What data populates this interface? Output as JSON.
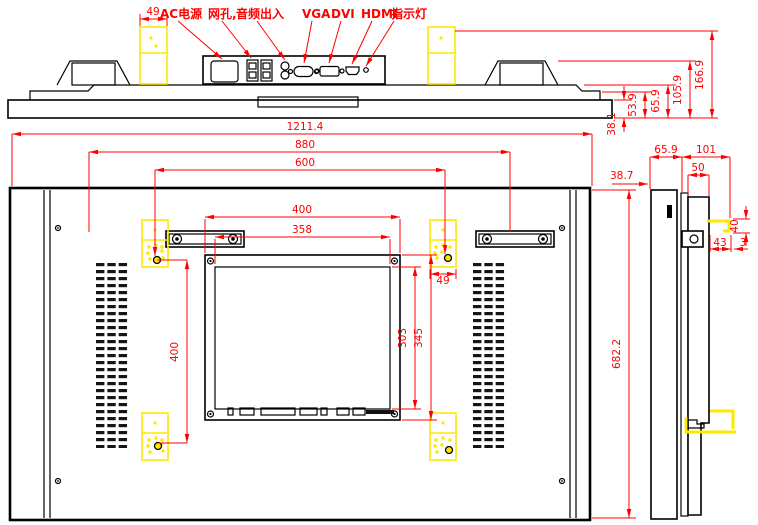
{
  "callouts": {
    "ac_power": "AC电源",
    "lan": "网孔,",
    "audio": "音频出入",
    "vga": "VGA",
    "dvi": "DVI",
    "hdmi": "HDMI",
    "indicator": "指示灯"
  },
  "dims": {
    "top": {
      "bracket_w": "49",
      "step": "53.9",
      "front": "65.9",
      "mid": "105.9",
      "overall": "166.9",
      "body": "38.1"
    },
    "rear": {
      "overall_w": "1211.4",
      "handle_span": "880",
      "mount_span_w": "600",
      "box_w": "400",
      "box_inner_w": "358",
      "block_w": "49",
      "mount_span_h": "400",
      "box_inner_h": "303",
      "box_h": "345",
      "overall_h": "682.2"
    },
    "side": {
      "front_depth": "65.9",
      "rear_depth": "101",
      "bezel": "38.7",
      "box_depth": "50",
      "hook_h": "40",
      "hook_w": "43",
      "hook_lip": "3"
    }
  },
  "colors": {
    "dimension": "#ff0000",
    "highlight": "#ffe800",
    "line": "#000000",
    "background": "#ffffff"
  }
}
